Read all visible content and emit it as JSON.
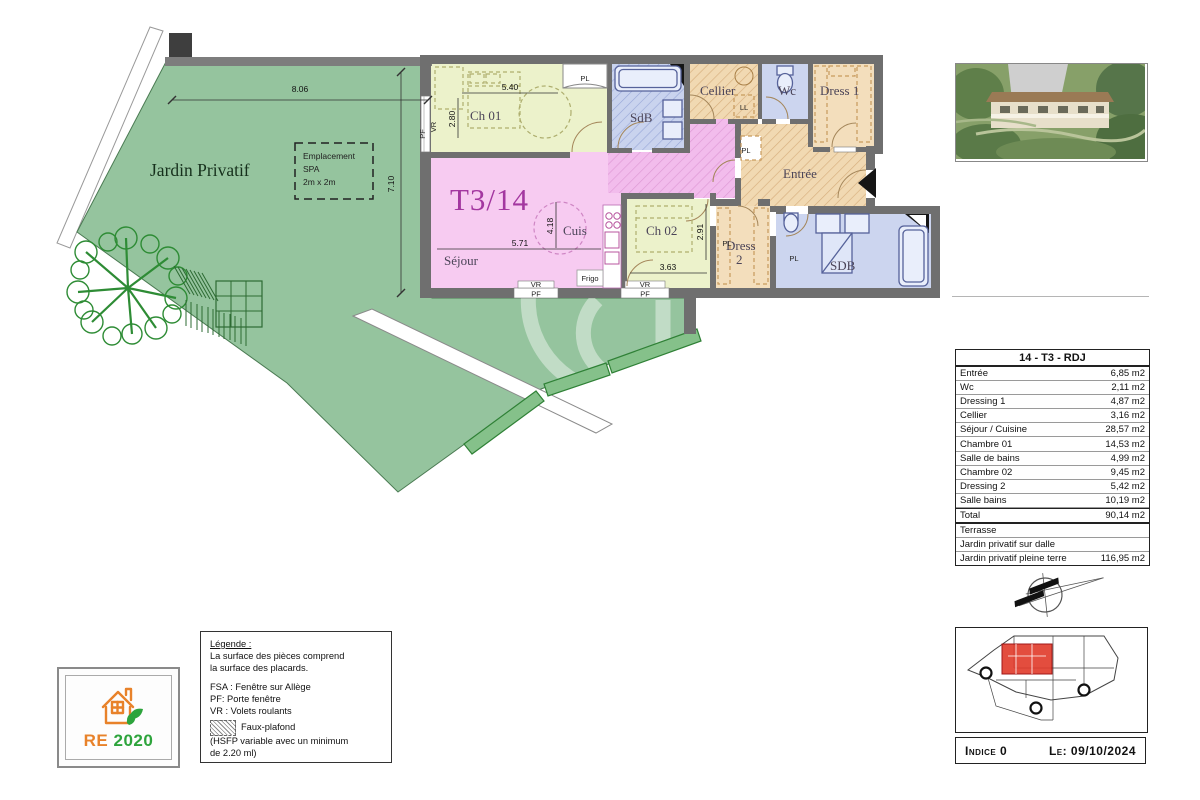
{
  "plan": {
    "unit_label": "T3/14",
    "garden_label": "Jardin Privatif",
    "spa_line1": "Emplacement",
    "spa_line2": "SPA",
    "spa_line3": "2m x 2m",
    "rooms": {
      "ch01": "Ch 01",
      "sdb_top": "SdB",
      "cellier": "Cellier",
      "wc": "Wc",
      "dress1": "Dress 1",
      "entree": "Entrée",
      "sejour": "Séjour",
      "cuisine": "Cuis",
      "ch02": "Ch 02",
      "dress2_l1": "Dress",
      "dress2_l2": "2",
      "sdb_bottom": "SDB"
    },
    "dimensions": {
      "garden_width": "8.06",
      "garden_height": "7.10",
      "ch01_width": "5.40",
      "ch01_height": "2.80",
      "sejour_width": "5.71",
      "cuisine_height": "4.18",
      "ch02_width": "3.63",
      "ch02_height": "2.91"
    },
    "annotations": {
      "pl": "PL",
      "ll": "LL",
      "frigo": "Frigo",
      "vr": "VR",
      "pf": "PF"
    }
  },
  "table": {
    "title": "14 - T3 - RDJ",
    "rows": [
      {
        "label": "Entrée",
        "value": "6,85 m2"
      },
      {
        "label": "Wc",
        "value": "2,11 m2"
      },
      {
        "label": "Dressing 1",
        "value": "4,87 m2"
      },
      {
        "label": "Cellier",
        "value": "3,16 m2"
      },
      {
        "label": "Séjour / Cuisine",
        "value": "28,57 m2"
      },
      {
        "label": "Chambre 01",
        "value": "14,53 m2"
      },
      {
        "label": "Salle de bains",
        "value": "4,99 m2"
      },
      {
        "label": "Chambre 02",
        "value": "9,45 m2"
      },
      {
        "label": "Dressing 2",
        "value": "5,42 m2"
      },
      {
        "label": "Salle bains",
        "value": "10,19 m2"
      }
    ],
    "total": {
      "label": "Total",
      "value": "90,14 m2"
    },
    "extra_rows": [
      {
        "label": "Terrasse",
        "value": ""
      },
      {
        "label": "Jardin privatif sur dalle",
        "value": ""
      },
      {
        "label": "Jardin privatif pleine terre",
        "value": "116,95 m2"
      }
    ]
  },
  "legend": {
    "heading": "Légende :",
    "line1": "La surface des pièces comprend",
    "line2": "la surface des placards.",
    "fsa": "FSA : Fenêtre sur Allège",
    "pf": "PF: Porte fenêtre",
    "vr": "VR : Volets roulants",
    "faux_plafond": "Faux-plafond",
    "hsfp1": "(HSFP variable avec un minimum",
    "hsfp2": "de 2.20 ml)"
  },
  "re2020": {
    "re": "RE",
    "year": "2020"
  },
  "title_block": {
    "indice": "Indice  0",
    "date": "Le: 09/10/2024"
  }
}
